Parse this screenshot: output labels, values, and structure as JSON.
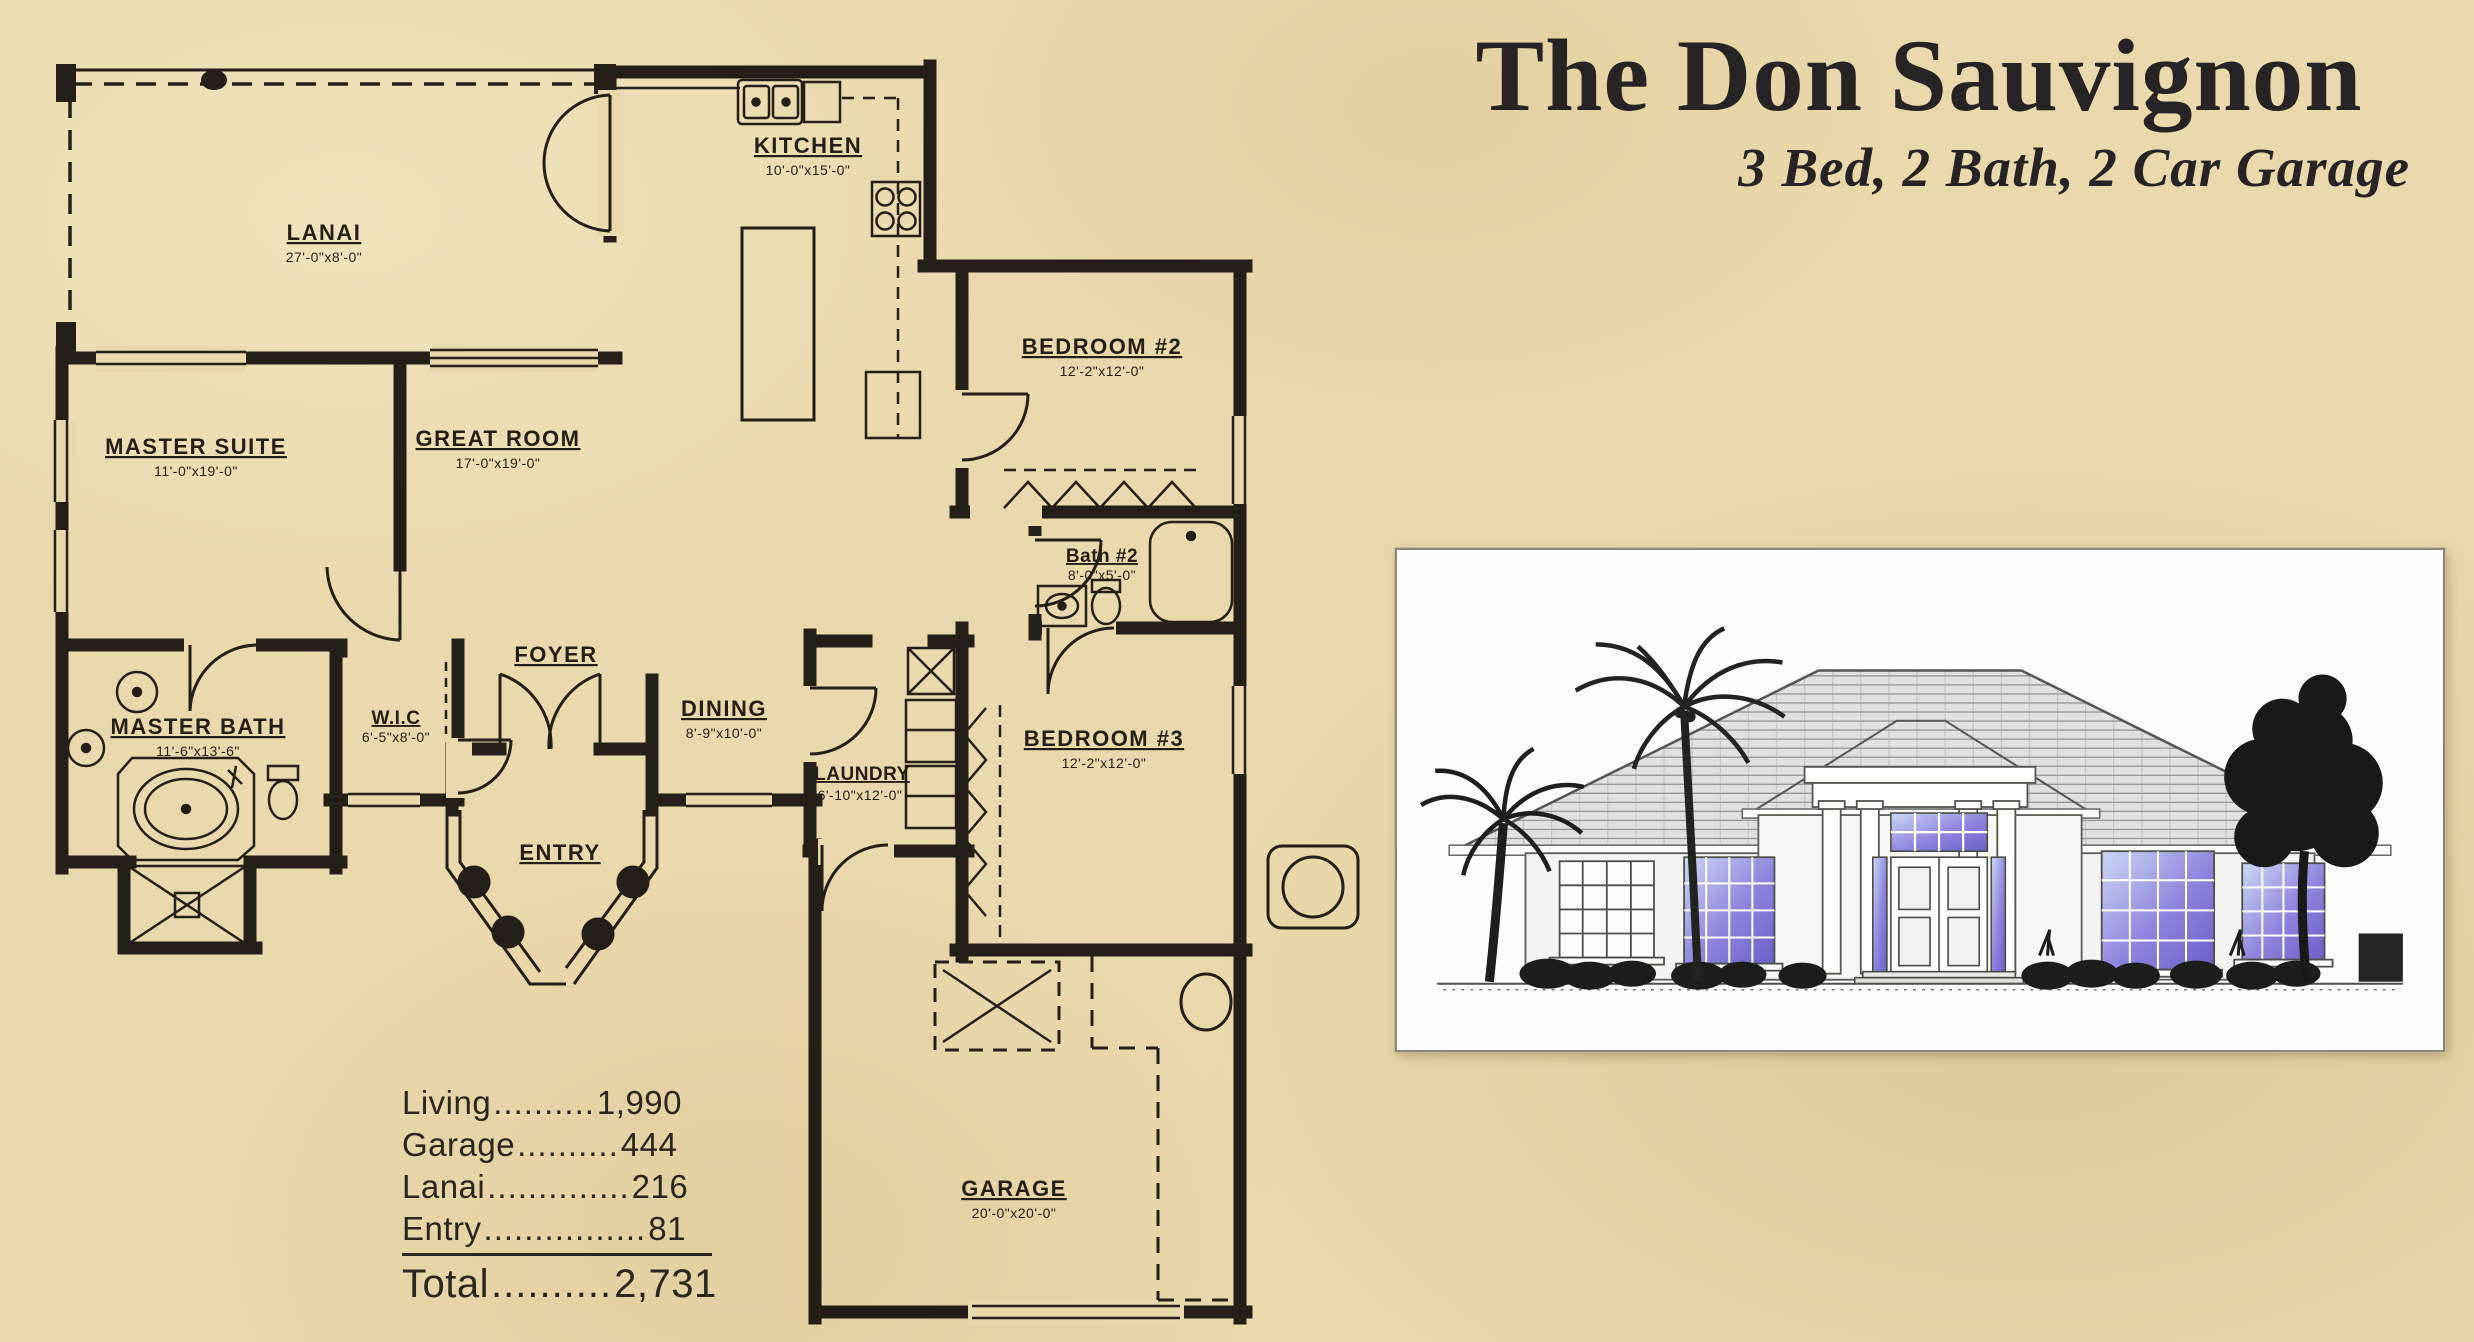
{
  "header": {
    "title": "The Don Sauvignon",
    "subtitle": "3 Bed, 2 Bath, 2 Car Garage"
  },
  "floorplan": {
    "rooms": {
      "lanai": {
        "label": "LANAI",
        "dim": "27'-0\"x8'-0\""
      },
      "kitchen": {
        "label": "KITCHEN",
        "dim": "10'-0\"x15'-0\""
      },
      "master_suite": {
        "label": "MASTER SUITE",
        "dim": "11'-0\"x19'-0\""
      },
      "great_room": {
        "label": "GREAT ROOM",
        "dim": "17'-0\"x19'-0\""
      },
      "bedroom_2": {
        "label": "BEDROOM #2",
        "dim": "12'-2\"x12'-0\""
      },
      "bath_2": {
        "label": "Bath #2",
        "dim": "8'-0\"x5'-0\""
      },
      "master_bath": {
        "label": "MASTER BATH",
        "dim": "11'-6\"x13'-6\""
      },
      "wic": {
        "label": "W.I.C",
        "dim": "6'-5\"x8'-0\""
      },
      "foyer": {
        "label": "FOYER"
      },
      "entry": {
        "label": "ENTRY"
      },
      "dining": {
        "label": "DINING",
        "dim": "8'-9\"x10'-0\""
      },
      "laundry": {
        "label": "LAUNDRY",
        "dim": "6'-10\"x12'-0\""
      },
      "bedroom_3": {
        "label": "BEDROOM #3",
        "dim": "12'-2\"x12'-0\""
      },
      "garage": {
        "label": "GARAGE",
        "dim": "20'-0\"x20'-0\""
      }
    },
    "area_table": {
      "rows": [
        {
          "label": "Living",
          "dots": "..........",
          "value": "1,990"
        },
        {
          "label": "Garage",
          "dots": "..........",
          "value": "444"
        },
        {
          "label": "Lanai",
          "dots": "..............",
          "value": "216"
        },
        {
          "label": "Entry",
          "dots": "................",
          "value": "81"
        }
      ],
      "total": {
        "label": "Total",
        "dots": "..........",
        "value": "2,731"
      }
    }
  },
  "colors": {
    "paper": "#e9d8ab",
    "ink": "#241f18",
    "window_glass_dark": "#6a5fc9",
    "window_glass_light": "#cdd8f5"
  }
}
